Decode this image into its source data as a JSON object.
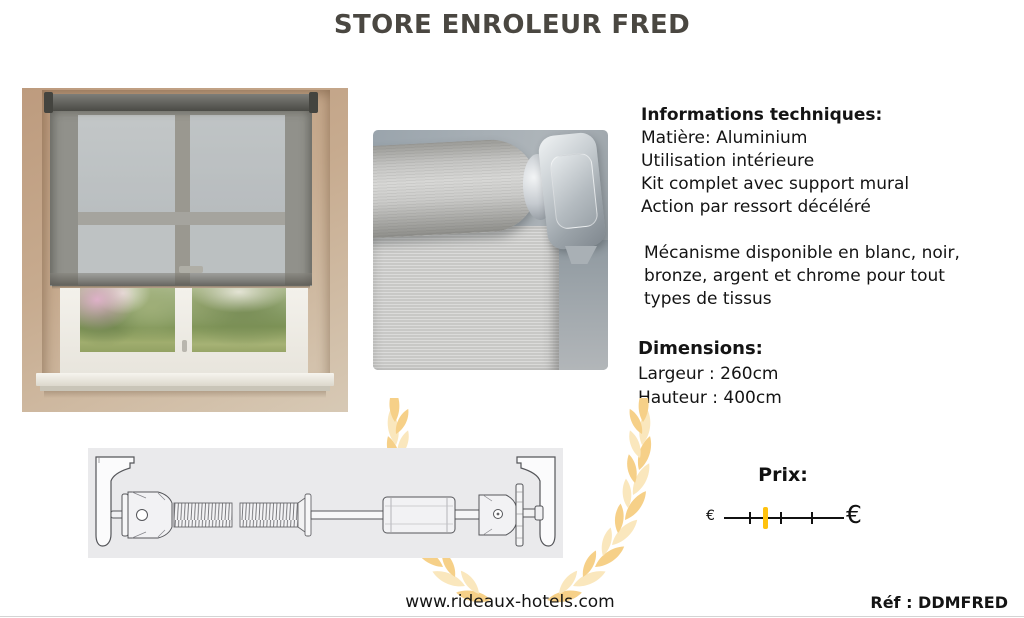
{
  "title": "STORE ENROLEUR FRED",
  "info": {
    "heading": "Informations techniques:",
    "lines": [
      "Matière: Aluminium",
      "Utilisation intérieure",
      "Kit complet avec support mural",
      "Action par ressort décéléré"
    ],
    "paragraph": "Mécanisme disponible en blanc, noir, bronze, argent et chrome pour tout types de tissus"
  },
  "dimensions": {
    "heading": "Dimensions:",
    "width_line": "Largeur : 260cm",
    "height_line": "Hauteur : 400cm"
  },
  "price": {
    "label": "Prix:",
    "min_symbol": "€",
    "max_symbol": "€",
    "marker_fraction": 0.35
  },
  "footer": {
    "website": "www.rideaux-hotels.com",
    "reference": "Réf : DDMFRED"
  },
  "colors": {
    "title": "#4a4741",
    "laurel_gold": "#f6d088",
    "laurel_gold_light": "#fae7bd",
    "price_marker": "#ffc20e",
    "wall_beige": "#c7ab8f",
    "blind_gray": "#9e9b94"
  },
  "images": {
    "window_photo": "roller-blind-on-window-photo",
    "mechanism_photo": "roller-blind-mechanism-closeup",
    "technical_drawing": "roller-mechanism-technical-drawing",
    "watermark": "gold-laurel-wreath-watermark"
  }
}
